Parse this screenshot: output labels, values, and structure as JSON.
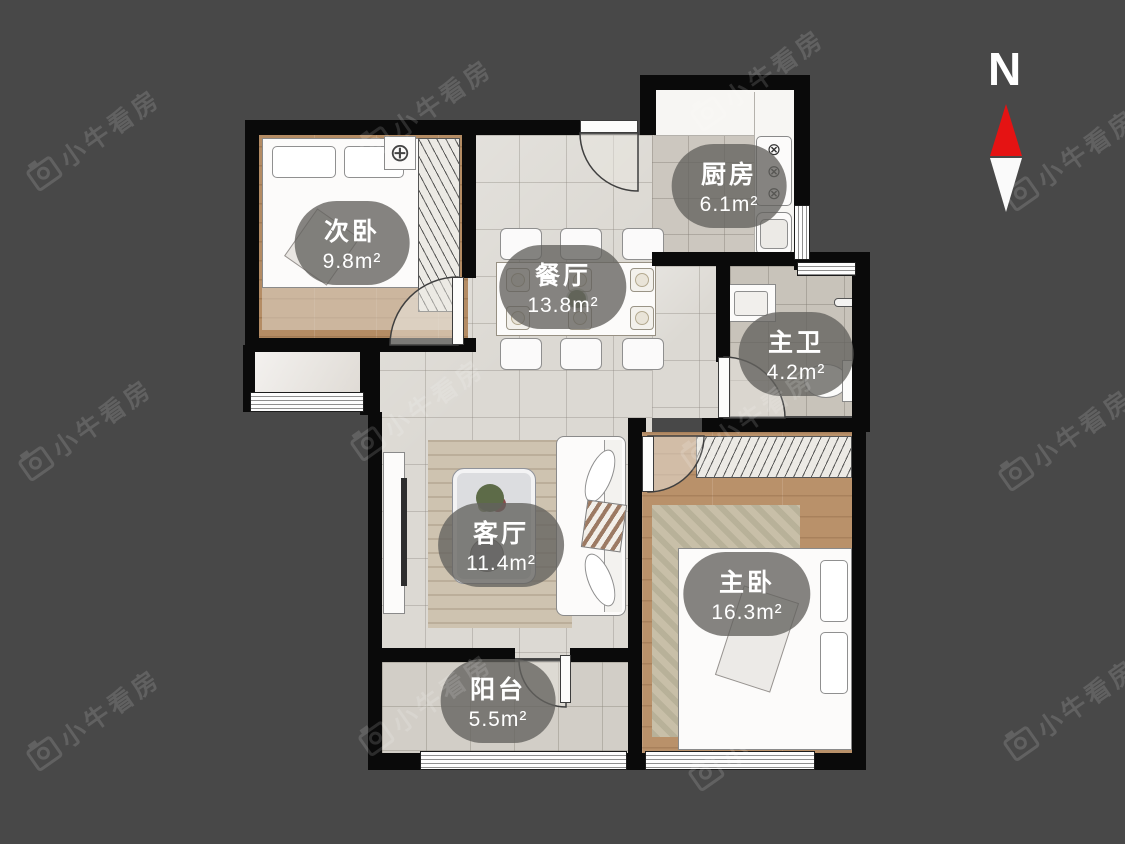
{
  "watermark": {
    "text": "小牛看房"
  },
  "north_indicator": {
    "label": "N"
  },
  "rooms": [
    {
      "id": "bedroom-secondary",
      "name": "次卧",
      "area": "9.8m²"
    },
    {
      "id": "dining-room",
      "name": "餐厅",
      "area": "13.8m²"
    },
    {
      "id": "kitchen",
      "name": "厨房",
      "area": "6.1m²"
    },
    {
      "id": "bathroom-master",
      "name": "主卫",
      "area": "4.2m²"
    },
    {
      "id": "living-room",
      "name": "客厅",
      "area": "11.4m²"
    },
    {
      "id": "bedroom-master",
      "name": "主卧",
      "area": "16.3m²"
    },
    {
      "id": "balcony",
      "name": "阳台",
      "area": "5.5m²"
    }
  ],
  "icons": {
    "ceiling-fan": "⊕",
    "stove-burner": "⊗"
  },
  "colors": {
    "background": "#484848",
    "wall": "#0a0a0a",
    "wood_floor": "#b48c64",
    "tile_floor": "#dcd9d3",
    "label_bubble": "rgba(99,97,93,0.78)",
    "north_red": "#e51313"
  }
}
